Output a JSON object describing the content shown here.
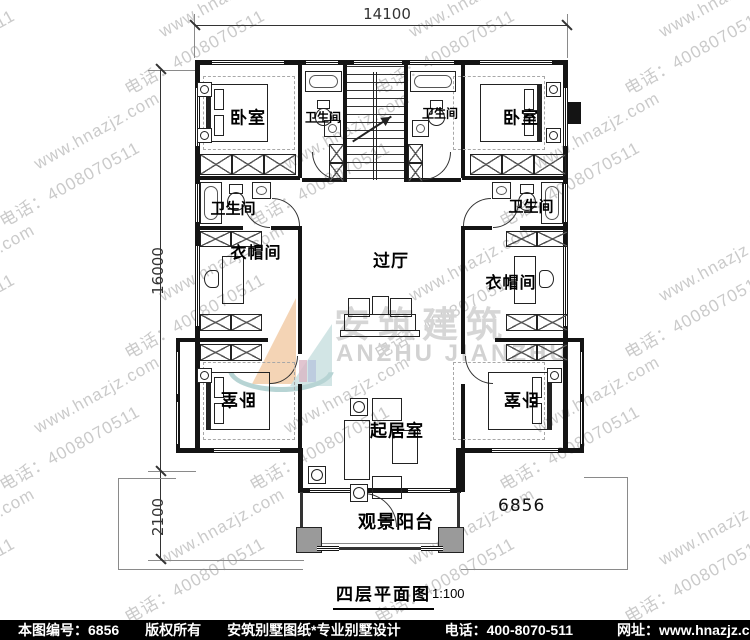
{
  "watermark": {
    "site": "www.hnazjz.com",
    "phone": "电话：4008070511"
  },
  "dimensions": {
    "width_top": "14100",
    "height_main": "16000",
    "height_balcony": "2100"
  },
  "rooms": {
    "bedroom": "卧室",
    "bathroom": "卫生间",
    "cloakroom": "衣帽间",
    "hall": "过厅",
    "living_room": "起居室",
    "balcony": "观景阳台"
  },
  "plan_number": "6856",
  "title": {
    "name": "四层平面图",
    "scale": "1:100"
  },
  "logo": {
    "cn": "安筑建筑",
    "en": "ANZHU JIANZHU"
  },
  "footer": {
    "drawing_no": "本图编号：6856",
    "copyright": "版权所有",
    "studio": "安筑别墅图纸*专业别墅设计",
    "phone": "电话：400-8070-511",
    "website": "网址：www.hnazjz.com"
  }
}
